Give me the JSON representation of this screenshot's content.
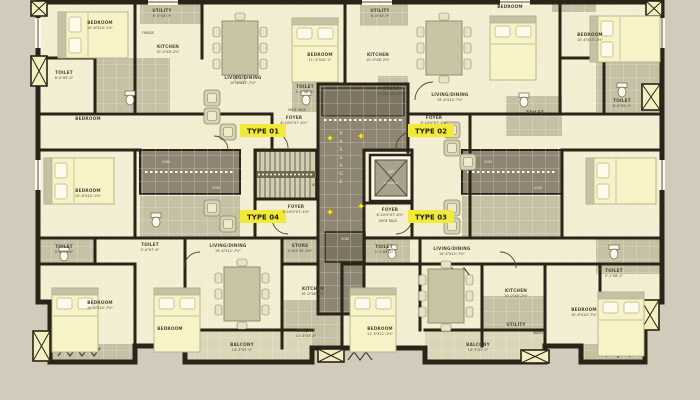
{
  "title": "apartment-typical-floor-plan",
  "colors": {
    "background": "#d2cbbc",
    "room": "#f3edd1",
    "service": "#c6c1a4",
    "balcony": "#dbd6b8",
    "core": "#8e8672",
    "core_dark": "#7d7562",
    "wall": "#2a2318",
    "bed": "#f8f3c6",
    "furniture": "#cfcab0",
    "type_badge_bg": "#f2ea3a",
    "label_text": "#4f4836",
    "marker_yellow": "#ffe61e"
  },
  "badges": {
    "type01": "TYPE 01",
    "type02": "TYPE 02",
    "type03": "TYPE 03",
    "type04": "TYPE 04"
  },
  "core": {
    "passage": "PASSAGE",
    "up": "UP",
    "void": "VOID",
    "lift": {
      "name": "LIFT",
      "dims": "5'-0\"X5'-9\""
    },
    "shoe_rack": "SHOE RACK"
  },
  "rooms": {
    "bedroom_sm": {
      "name": "BEDROOM",
      "dims": "10'-6\"X10'-1½\""
    },
    "bedroom_md": {
      "name": "BEDROOM",
      "dims": "11'-3\"X10'-2\""
    },
    "bedroom_lg": {
      "name": "BEDROOM",
      "dims": "11'-3\"X12'-1½\""
    },
    "bedroom_xl": {
      "name": "BEDROOM",
      "dims": "10'-6\"X10'-7½\""
    },
    "toilet_a": {
      "name": "TOILET",
      "dims": "8'-0\"X5'-0\""
    },
    "toilet_b": {
      "name": "TOILET",
      "dims": "5'-0\"X7'-6\""
    },
    "toilet_c": {
      "name": "TOILET",
      "dims": "5'-1\"X6'-2\""
    },
    "kitchen": {
      "name": "KITCHEN",
      "dims": "10'-0\"X8'-2½\""
    },
    "living": {
      "name": "LIVING/DINING",
      "dims": "19'-4\"X12'-7½\""
    },
    "foyer": {
      "name": "FOYER",
      "dims": "6'-10½\"X7'-4½\""
    },
    "store": {
      "name": "STORE",
      "dims": "4'-6½\"X5'-4½\""
    },
    "utility": {
      "name": "UTILITY",
      "dims": "11'-3\"X3'-4\""
    },
    "utility_sm": {
      "name": "UTILITY",
      "dims": "6'-0\"X3'-9\""
    },
    "balcony": {
      "name": "BALCONY",
      "dims": "14'-3\"X5'-0\""
    },
    "wash": {
      "name": "WASH"
    },
    "fridge": {
      "name": "FRIDGE"
    }
  }
}
